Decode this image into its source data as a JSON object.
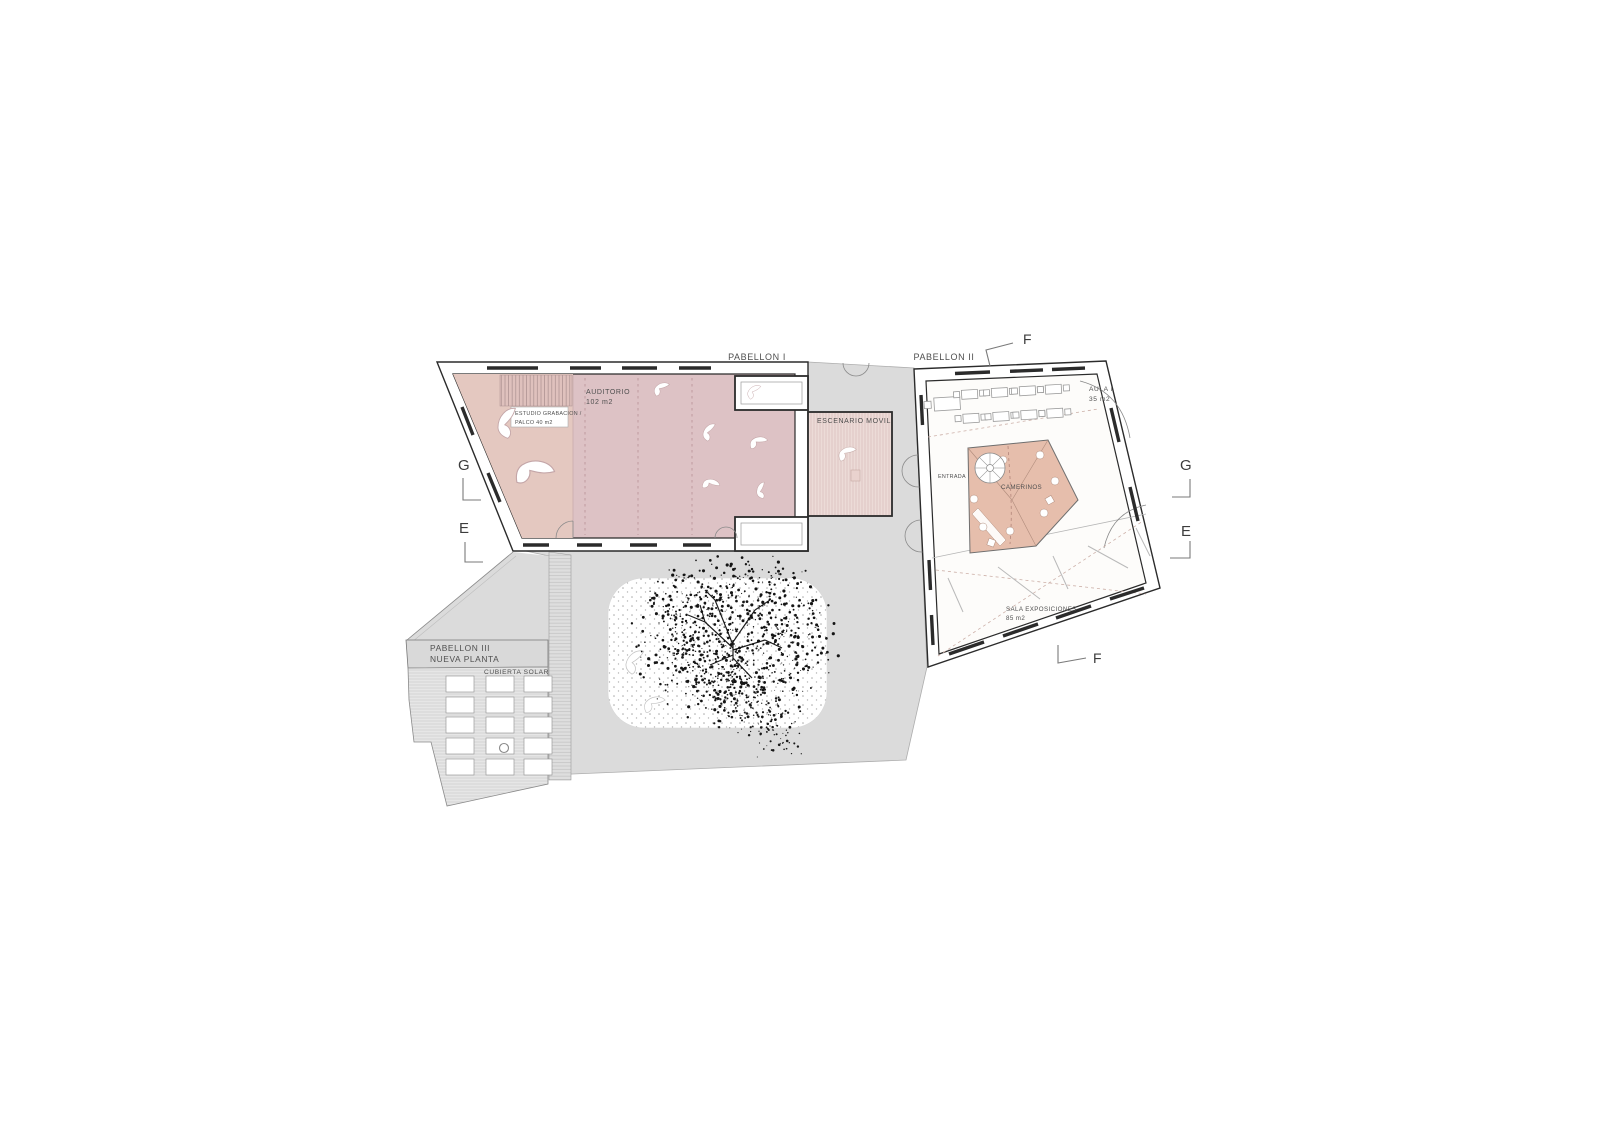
{
  "titles": {
    "p1": "PABELLON I",
    "p2": "PABELLON II"
  },
  "rooms": {
    "auditorio": {
      "name": "AUDITORIO",
      "area": "102 m2"
    },
    "estudio": {
      "l1": "ESTUDIO GRABACION /",
      "l2": "PALCO  40 m2"
    },
    "escenario": {
      "name": "ESCENARIO MOVIL"
    },
    "aula": {
      "name": "AULA I",
      "area": "35 m2"
    },
    "entrada": {
      "name": "ENTRADA"
    },
    "camerinos": {
      "name": "CAMERINOS"
    },
    "sala": {
      "name": "SALA EXPOSICIONES",
      "area": "85 m2"
    },
    "pabellon3": {
      "l1": "PABELLON III",
      "l2": "NUEVA PLANTA"
    },
    "cubierta": {
      "name": "CUBIERTA SOLAR"
    }
  },
  "markers": {
    "f_top": "F",
    "f_bottom": "F",
    "g_left": "G",
    "e_left": "E",
    "g_right": "G",
    "e_right": "E"
  },
  "colors": {
    "auditorio": "#ddc2c5",
    "palco": "#e4c8c0",
    "escenario": "#ecdbd7",
    "escenario_stripe": "#d8bebb",
    "camerinos": "#e6beac",
    "courtyard": "#dbdbdb",
    "solar": "#e6e6e6",
    "walkway": "#e0e0e0",
    "band": "#d9d9d9",
    "wall": "#2b2b2b",
    "label": "#4f4f4f",
    "marker": "#3c3c3c",
    "pink_dash": "#bb959a"
  }
}
